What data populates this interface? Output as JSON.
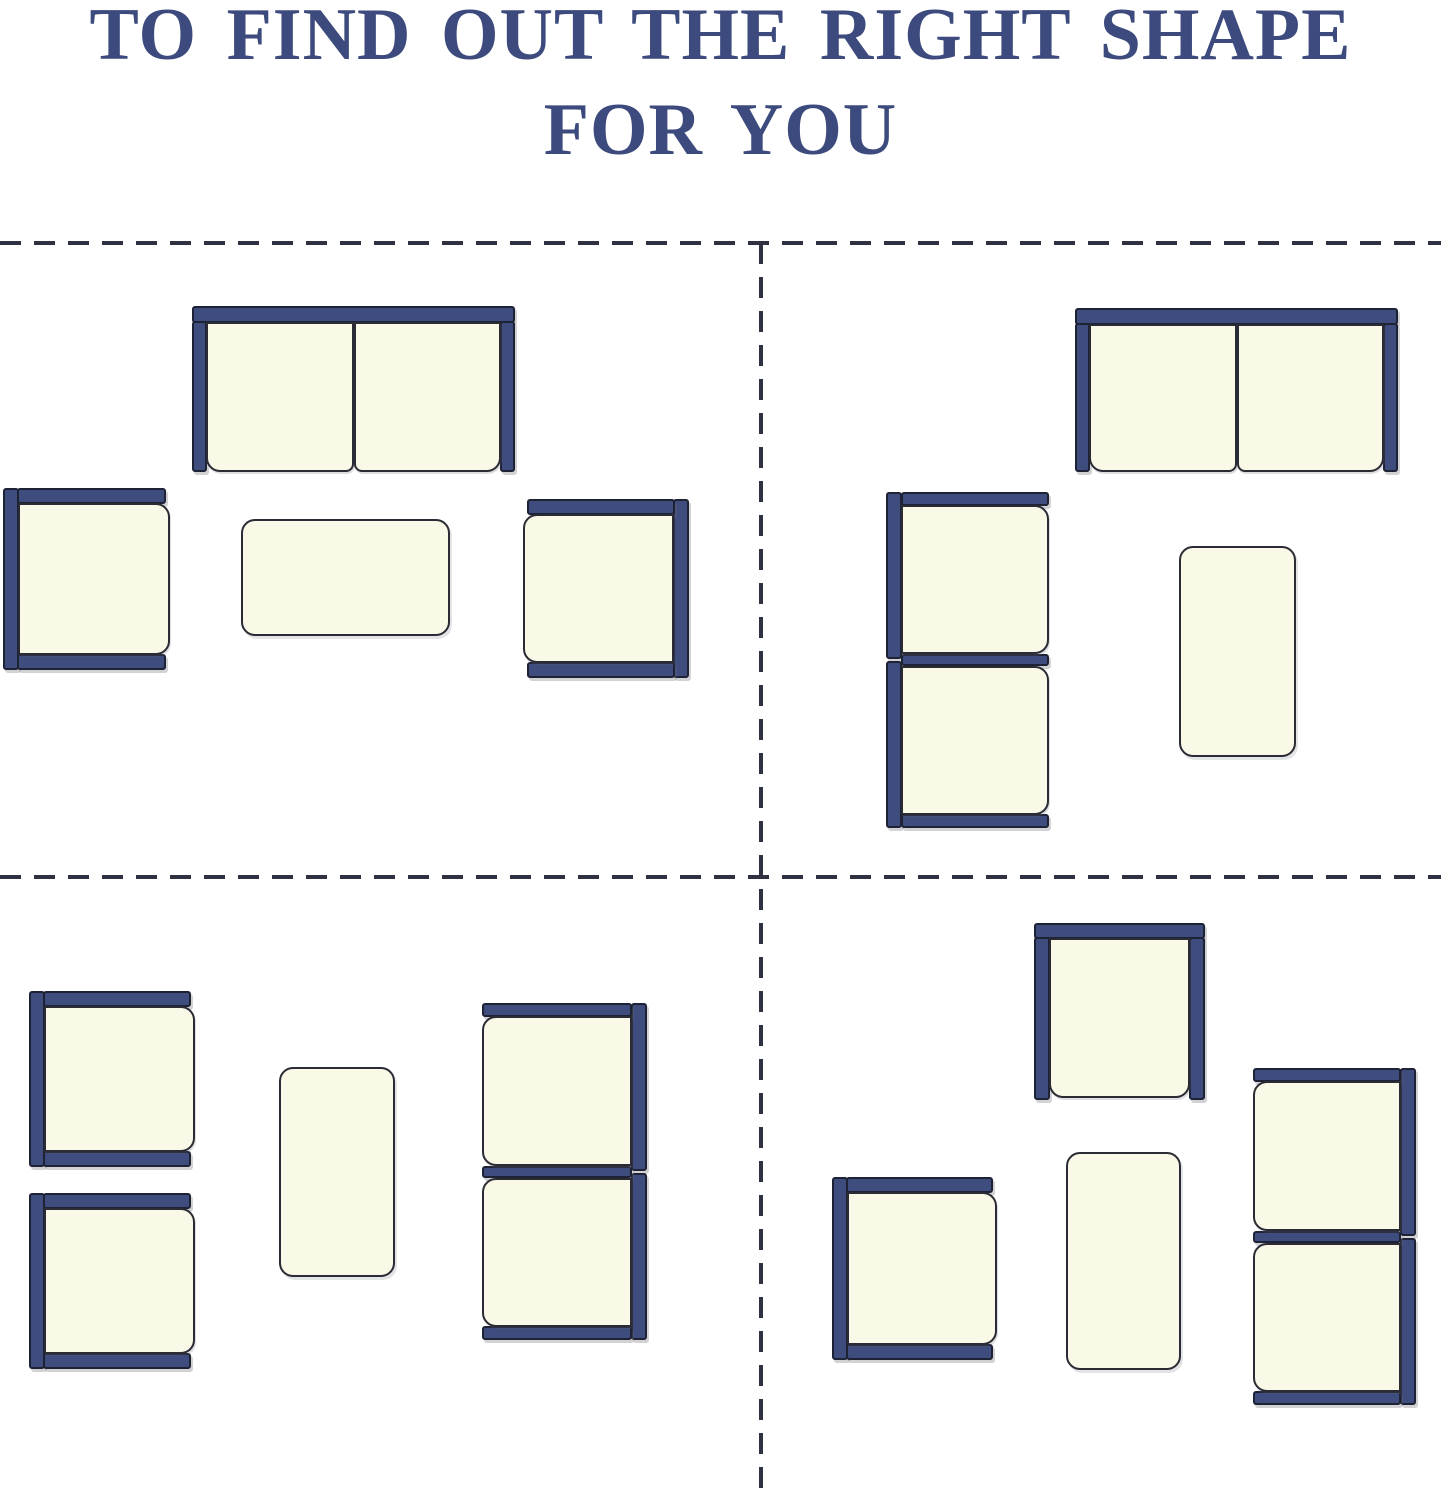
{
  "title": {
    "line1": "TO FIND OUT THE RIGHT SHAPE",
    "line2": "FOR YOU"
  },
  "colors": {
    "background": "#ffffff",
    "title_navy": "#3c4a7d",
    "frame_navy": "#3e4c7e",
    "frame_outline": "#1e2235",
    "cushion_cream": "#faf8e7",
    "cushion_outline": "#2b2b35",
    "divider_dash": "#2d3142"
  },
  "diagram": {
    "canvas": {
      "width": 1441,
      "height": 1500
    },
    "dividers": {
      "horizontal_y": [
        241,
        875
      ],
      "vertical": {
        "x": 759,
        "y_start": 243,
        "y_end": 1500
      }
    },
    "quadrants": [
      {
        "id": "top-left",
        "pieces": [
          {
            "type": "loveseat",
            "back": "top",
            "x": 192,
            "y": 306,
            "w": 323,
            "h": 166
          },
          {
            "type": "armchair",
            "back": "left",
            "x": 3,
            "y": 488,
            "w": 167,
            "h": 182
          },
          {
            "type": "armchair",
            "back": "right",
            "x": 523,
            "y": 499,
            "w": 166,
            "h": 179
          },
          {
            "type": "table",
            "orientation": "horizontal",
            "x": 241,
            "y": 519,
            "w": 209,
            "h": 117
          }
        ]
      },
      {
        "id": "top-right",
        "pieces": [
          {
            "type": "loveseat",
            "back": "top",
            "x": 1075,
            "y": 308,
            "w": 323,
            "h": 164
          },
          {
            "type": "sofa-2seat",
            "back": "left",
            "x": 886,
            "y": 492,
            "w": 164,
            "h": 336
          },
          {
            "type": "table",
            "orientation": "vertical",
            "x": 1179,
            "y": 546,
            "w": 117,
            "h": 211
          }
        ]
      },
      {
        "id": "bottom-left",
        "pieces": [
          {
            "type": "armchair",
            "back": "left",
            "x": 29,
            "y": 991,
            "w": 166,
            "h": 176
          },
          {
            "type": "armchair",
            "back": "left",
            "x": 29,
            "y": 1193,
            "w": 166,
            "h": 176
          },
          {
            "type": "table",
            "orientation": "vertical",
            "x": 279,
            "y": 1067,
            "w": 116,
            "h": 210
          },
          {
            "type": "sofa-2seat",
            "back": "right",
            "x": 481,
            "y": 1003,
            "w": 166,
            "h": 337
          }
        ]
      },
      {
        "id": "bottom-right",
        "pieces": [
          {
            "type": "armchair",
            "back": "top",
            "x": 1034,
            "y": 923,
            "w": 171,
            "h": 177
          },
          {
            "type": "armchair",
            "back": "left",
            "x": 832,
            "y": 1177,
            "w": 165,
            "h": 183
          },
          {
            "type": "table",
            "orientation": "vertical",
            "x": 1066,
            "y": 1152,
            "w": 115,
            "h": 218
          },
          {
            "type": "sofa-2seat",
            "back": "right",
            "x": 1252,
            "y": 1068,
            "w": 164,
            "h": 337
          }
        ]
      }
    ]
  }
}
